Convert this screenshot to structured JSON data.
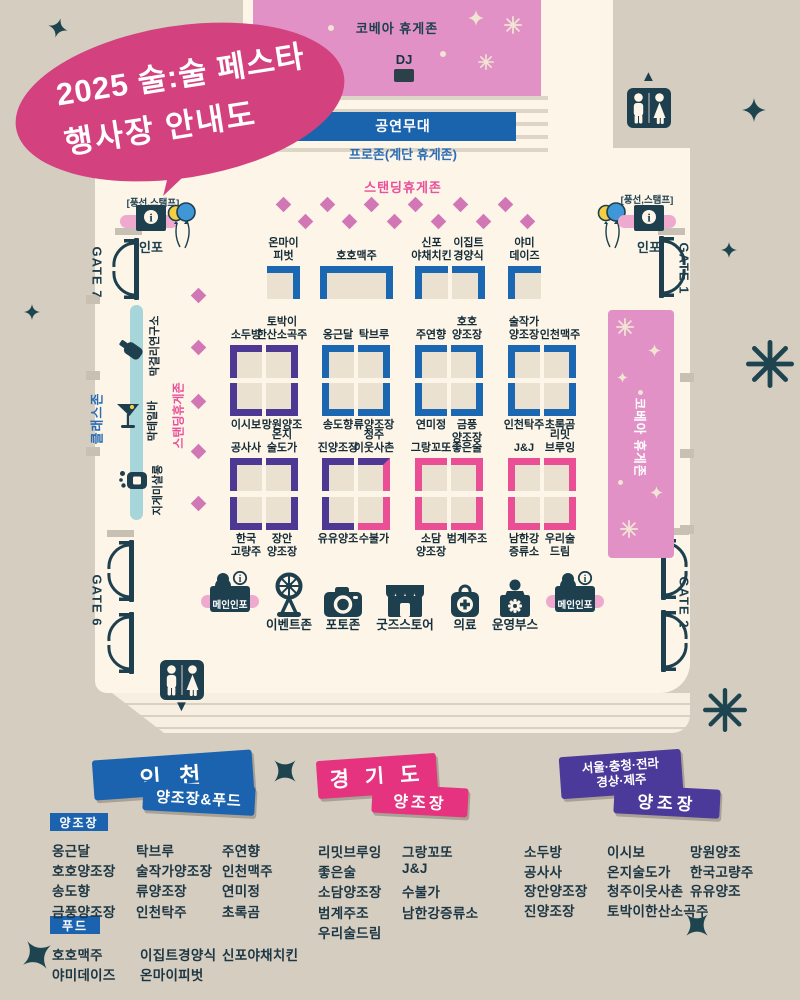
{
  "title": {
    "line1": "2025 술:술 페스타",
    "line2": "행사장 안내도"
  },
  "zones": {
    "kovea_top": "코베아 휴게존",
    "dj": "DJ",
    "stage": "공연무대",
    "pro_zone": "프로존(계단 휴게존)",
    "standing": "스탠딩휴게존",
    "standing_left": "스탠딩휴게존",
    "kovea_right": "코베아 휴게존",
    "class_zone": "클래스존"
  },
  "gates": {
    "gate7": "GATE 7",
    "gate1": "GATE 1",
    "gate6": "GATE 6",
    "gate2": "GATE 2"
  },
  "info_booth": {
    "tag": "[풍선,스탬프]",
    "label": "인포"
  },
  "class_items": [
    {
      "label": "막걸리연구소",
      "icon": "bottle-icon"
    },
    {
      "label": "막테일바",
      "icon": "cocktail-icon"
    },
    {
      "label": "지게미살롱",
      "icon": "soap-icon"
    }
  ],
  "booths": {
    "row1": [
      {
        "label": "온마이\n피벗",
        "color": "blue"
      },
      {
        "label": "호호맥주",
        "color": "blue"
      },
      {
        "label": "신포\n야채치킨",
        "color": "blue"
      },
      {
        "label": "이집트\n경양식",
        "color": "blue"
      },
      {
        "label": "야미\n데이즈",
        "color": "blue"
      }
    ],
    "row2": [
      {
        "label": "소두방",
        "color": "purple"
      },
      {
        "label": "토박이\n한산소곡주",
        "color": "purple"
      },
      {
        "label": "옹근달",
        "color": "blue"
      },
      {
        "label": "탁브루",
        "color": "blue"
      },
      {
        "label": "주연향",
        "color": "blue"
      },
      {
        "label": "호호\n양조장",
        "color": "blue"
      },
      {
        "label": "술작가\n양조장",
        "color": "blue"
      },
      {
        "label": "인천맥주",
        "color": "blue"
      }
    ],
    "row3": [
      {
        "label": "이시보",
        "color": "purple"
      },
      {
        "label": "망원양조",
        "color": "purple"
      },
      {
        "label": "송도향",
        "color": "blue"
      },
      {
        "label": "류양조장",
        "color": "blue"
      },
      {
        "label": "연미정",
        "color": "blue"
      },
      {
        "label": "금풍\n양조장",
        "color": "blue"
      },
      {
        "label": "인천탁주",
        "color": "blue"
      },
      {
        "label": "초록곰",
        "color": "blue"
      }
    ],
    "row4": [
      {
        "label": "공사사",
        "color": "purple"
      },
      {
        "label": "온지\n술도가",
        "color": "purple"
      },
      {
        "label": "진양조장",
        "color": "purple"
      },
      {
        "label": "청주\n이웃사촌",
        "color": "purple",
        "accent": "pink"
      },
      {
        "label": "그랑꼬또",
        "color": "pink"
      },
      {
        "label": "좋은술",
        "color": "pink"
      },
      {
        "label": "J&J",
        "color": "pink"
      },
      {
        "label": "리밋\n브루잉",
        "color": "pink"
      }
    ],
    "row5": [
      {
        "label": "한국\n고량주",
        "color": "purple"
      },
      {
        "label": "장안\n양조장",
        "color": "purple"
      },
      {
        "label": "유유양조",
        "color": "purple"
      },
      {
        "label": "수불가",
        "color": "pink"
      },
      {
        "label": "소담\n양조장",
        "color": "pink"
      },
      {
        "label": "범계주조",
        "color": "pink"
      },
      {
        "label": "남한강\n증류소",
        "color": "pink"
      },
      {
        "label": "우리술\n드림",
        "color": "pink"
      }
    ]
  },
  "facilities": [
    {
      "label": "메인인포",
      "icon": "info-desk-icon"
    },
    {
      "label": "이벤트존",
      "icon": "prize-wheel-icon"
    },
    {
      "label": "포토존",
      "icon": "camera-icon"
    },
    {
      "label": "굿즈스토어",
      "icon": "store-icon"
    },
    {
      "label": "의료",
      "icon": "medical-icon"
    },
    {
      "label": "운영부스",
      "icon": "operations-icon"
    },
    {
      "label": "메인인포",
      "icon": "info-desk-icon"
    }
  ],
  "legend": {
    "incheon": {
      "banner_line1": "인 천",
      "banner_line2": "양조장&푸드",
      "brewery_tag": "양조장",
      "brewery_cols": [
        [
          "옹근달",
          "호호양조장",
          "송도향",
          "금풍양조장"
        ],
        [
          "탁브루",
          "술작가양조장",
          "류양조장",
          "인천탁주"
        ],
        [
          "주연향",
          "인천맥주",
          "연미정",
          "초록곰"
        ]
      ],
      "food_tag": "푸드",
      "food_cols": [
        [
          "호호맥주",
          "야미데이즈"
        ],
        [
          "이집트경양식",
          "온마이피벗"
        ],
        [
          "신포야채치킨"
        ]
      ]
    },
    "gyeonggi": {
      "banner_line1": "경 기 도",
      "banner_line2": "양조장",
      "cols": [
        [
          "리밋브루잉",
          "좋은술",
          "소담양조장",
          "범계주조",
          "우리술드림"
        ],
        [
          "그랑꼬또",
          "J&J",
          "수불가",
          "남한강증류소"
        ]
      ]
    },
    "regions": {
      "banner_line1": "서울·충청·전라",
      "banner_line2": "경상·제주",
      "banner_line3": "양조장",
      "cols": [
        [
          "소두방",
          "공사사",
          "장안양조장",
          "진양조장"
        ],
        [
          "이시보",
          "온지술도가",
          "청주이웃사촌",
          "토박이한산소곡주"
        ],
        [
          "망원양조",
          "한국고량주",
          "유유양조"
        ]
      ]
    }
  },
  "colors": {
    "blue": "#1b67b2",
    "purple": "#4d3893",
    "pink": "#ea4f96",
    "banner_blue": "#1b63af",
    "banner_pink": "#e5337f",
    "banner_purple": "#4b3a99",
    "dark": "#1d3f4e",
    "zone_pink": "#e291c7",
    "cream": "#fcf5e8",
    "tan": "#d5cdc0",
    "title_pink": "#d4417f",
    "pill_pink": "#efa9cf",
    "diamond_pink": "#d277b6",
    "class_bar_blue": "#a7d6da"
  }
}
